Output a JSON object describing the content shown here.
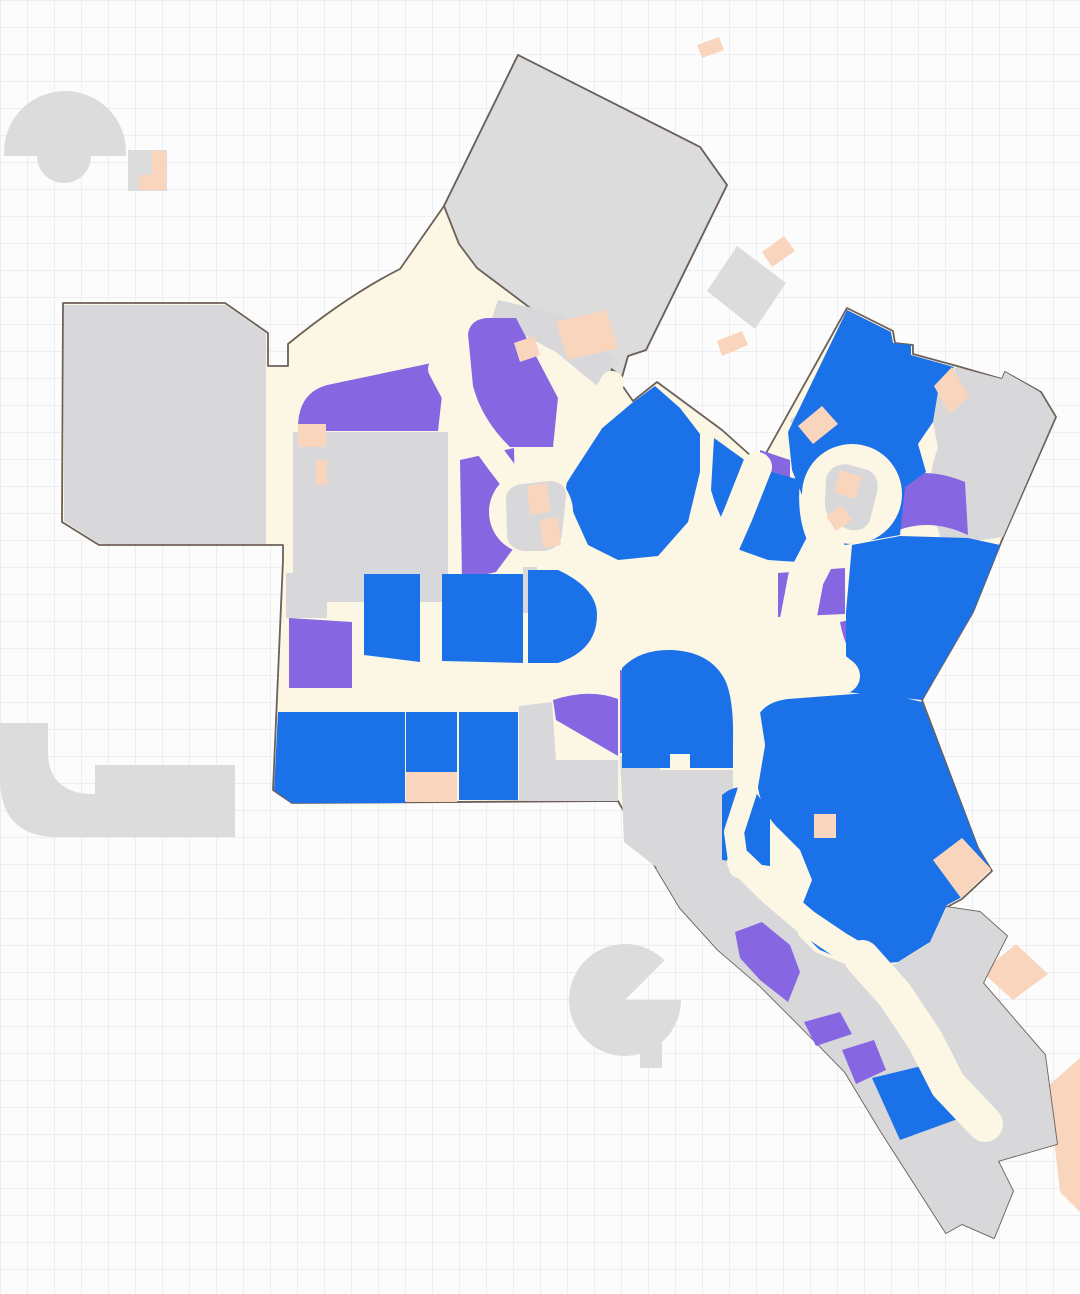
{
  "canvas": {
    "width": 1080,
    "height": 1294,
    "background": "#fcfcfd",
    "grid_color": "#eaeaee",
    "grid_size": 27
  },
  "palette": {
    "walkway": "#fbf7e4",
    "store_blue": "#1b72e8",
    "store_purple": "#8766e2",
    "store_peach": "#fad5bd",
    "store_gray": "#d8d8db",
    "detached_gray": "#dcdcdd",
    "outline": "#6c6058"
  },
  "map": {
    "name": "mall-floor-map",
    "shapes": [
      {
        "kind": "path",
        "name": "other-floor-fan-top-left",
        "fill": "detached_gray",
        "interactable": false,
        "d": "M4,152 A61,61 0 0 1 126,152 L126,156 L91,156 A27,27 0 0 1 37,156 L4,156 Z"
      },
      {
        "kind": "path",
        "name": "other-floor-unit-top-left",
        "fill": "detached_gray",
        "interactable": false,
        "d": "M128,150 L167,150 L167,191 L128,191 Z"
      },
      {
        "kind": "path",
        "name": "peach-unit-top-left",
        "fill": "store_peach",
        "interactable": false,
        "d": "M152,151 L166,151 L166,190 L139,190 L139,175 L152,175 Z"
      },
      {
        "kind": "path",
        "name": "other-floor-unit-upper-right",
        "fill": "detached_gray",
        "interactable": false,
        "d": "M737,246 L786,283 L755,329 L707,291 Z"
      },
      {
        "kind": "path",
        "name": "peach-strip-upper-right-a",
        "fill": "store_peach",
        "interactable": false,
        "d": "M762,252 L784,236 L795,251 L772,267 Z"
      },
      {
        "kind": "path",
        "name": "peach-strip-upper-right-b",
        "fill": "store_peach",
        "interactable": false,
        "d": "M717,341 L742,331 L748,345 L722,356 Z"
      },
      {
        "kind": "path",
        "name": "peach-strip-top",
        "fill": "store_peach",
        "interactable": false,
        "d": "M697,45 L719,37 L724,50 L702,58 Z"
      },
      {
        "kind": "path",
        "name": "other-floor-hook-lower-left",
        "fill": "detached_gray",
        "interactable": false,
        "d": "M0,723 L48,723 L48,755 Q50,792 90,794 L95,794 L95,765 L235,765 L235,837 L52,837 Q0,834 0,778 Z"
      },
      {
        "kind": "path",
        "name": "other-floor-fan-bottom",
        "fill": "detached_gray",
        "interactable": false,
        "d": "M625,1000 L664.6,960.4 A56,56 0 1 0 681,1000 Z"
      },
      {
        "kind": "path",
        "name": "other-floor-fan-bottom-tab",
        "fill": "detached_gray",
        "interactable": false,
        "d": "M640,1038 L662,1038 L662,1068 L640,1068 Z"
      },
      {
        "kind": "path",
        "name": "peach-block-right-lower",
        "fill": "store_peach",
        "interactable": false,
        "d": "M1048,1086 L1080,1058 L1080,1212 L1060,1192 Z"
      },
      {
        "kind": "path",
        "name": "peach-block-right-mid",
        "fill": "store_peach",
        "interactable": false,
        "d": "M982,972 L1016,944 L1048,974 L1013,1000 Z"
      },
      {
        "kind": "path",
        "name": "mall-walkway-footprint",
        "fill": "walkway",
        "stroke": true,
        "interactable": true,
        "d": "M63,303 L225,303 L268,333 L268,366 L288,366 L288,344 C315,322 356,291 400,269 L444,206 L518,55 L700,147 L727,185 L646,350 L628,356 L622,377 L610,368 L633,401 L657,382 L722,430 L760,464 L847,308 L893,331 L895,343 L913,345 L913,354 L957,366 L1002,379 L1005,372 L1041,392 L1056,417 L1002,540 L973,612 L922,700 L978,848 L992,871 L962,899 L947,907 L980,912 L1007,936 L983,983 L1045,1055 L1057,1144 L998,1161 L1013,1191 L994,1238 L962,1224 L946,1233 L880,1130 L845,1072 L800,1026 L760,986 L718,950 L680,908 L656,868 L618,801 L292,803 L273,790 L283,560 L283,545 L99,545 L62,522 Z"
      },
      {
        "kind": "path",
        "name": "anchor-store-top",
        "fill": "detached_gray",
        "stroke": true,
        "interactable": true,
        "d": "M518,55 L700,147 L727,185 L646,350 L628,356 L622,377 L610,368 L477,268 L459,244 L444,206 Z"
      },
      {
        "kind": "path",
        "name": "anchor-store-left",
        "fill": "store_gray",
        "interactable": true,
        "d": "M64,305 L225,305 L266,333 L266,544 L100,544 L64,521 Z"
      },
      {
        "kind": "path",
        "name": "service-block-left",
        "fill": "store_gray",
        "interactable": true,
        "d": "M293,432 L448,432 L448,602 L327,602 L327,618 L286,618 L286,573 L293,573 Z"
      },
      {
        "kind": "path",
        "name": "service-strip-top-center",
        "fill": "store_gray",
        "interactable": true,
        "d": "M498,300 L560,314 L616,357 L602,390 L556,352 L492,318 Z"
      },
      {
        "kind": "path",
        "name": "service-block-northeast",
        "fill": "store_gray",
        "interactable": true,
        "d": "M790,420 L818,398 L848,424 L848,462 L808,464 Z"
      },
      {
        "kind": "path",
        "name": "anchor-store-right",
        "fill": "store_gray",
        "interactable": true,
        "d": "M956,367 L1002,379 L1005,372 L1040,392 L1055,417 L1003,537 L944,545 Q920,492 938,448 L933,422 L938,392 Z"
      },
      {
        "kind": "path",
        "name": "service-block-south",
        "fill": "store_gray",
        "interactable": true,
        "d": "M519,706 L552,702 L556,760 L618,760 L618,801 L519,801 Z"
      },
      {
        "kind": "path",
        "name": "service-block-southeast",
        "fill": "store_gray",
        "interactable": true,
        "d": "M620,756 L660,756 L660,770 L733,770 L733,800 L745,800 L745,842 L718,872 L660,870 L624,842 Z"
      },
      {
        "kind": "path",
        "name": "tail-service-area",
        "fill": "store_gray",
        "interactable": true,
        "d": "M656,868 L680,908 L718,950 L760,986 L800,1026 L845,1072 L880,1130 L946,1233 L962,1224 L994,1238 L1013,1191 L998,1161 L1057,1144 L1045,1055 L983,983 L1007,936 L980,912 L947,907 L928,944 L895,964 L855,968 L815,952 L798,935 L797,906 L780,885 L735,845 L700,855 Z"
      },
      {
        "kind": "path",
        "name": "service-sliver-center",
        "fill": "store_gray",
        "interactable": true,
        "d": "M523,567 L537,567 L537,613 L523,613 Z"
      },
      {
        "kind": "path",
        "name": "store-purple-wing-band",
        "fill": "store_purple",
        "interactable": true,
        "d": "M298,428 Q298,390 332,384 L446,360 L438,431 L298,431 Z"
      },
      {
        "kind": "path",
        "name": "store-purple-upper-center",
        "fill": "store_purple",
        "interactable": true,
        "d": "M468,334 Q470,320 486,318 L516,318 L558,398 L553,447 L510,447 Q482,420 473,386 Z"
      },
      {
        "kind": "path",
        "name": "store-purple-mid-left",
        "fill": "store_purple",
        "interactable": true,
        "d": "M460,460 L514,448 L516,545 L496,572 L462,580 Z"
      },
      {
        "kind": "path",
        "name": "store-purple-lower-left",
        "fill": "store_purple",
        "interactable": true,
        "d": "M289,618 L352,622 L352,688 L289,688 Z"
      },
      {
        "kind": "path",
        "name": "store-purple-band-right",
        "fill": "store_purple",
        "interactable": true,
        "d": "M886,480 Q925,465 965,482 L968,535 Q925,515 888,535 Z"
      },
      {
        "kind": "path",
        "name": "store-purple-neck-west",
        "fill": "store_purple",
        "interactable": true,
        "d": "M760,450 L790,460 L790,494 L760,502 Z"
      },
      {
        "kind": "path",
        "name": "store-purple-band-mid",
        "fill": "store_purple",
        "interactable": true,
        "d": "M778,573 L845,568 L845,614 L778,617 Z"
      },
      {
        "kind": "path",
        "name": "store-purple-wedge-east",
        "fill": "store_purple",
        "interactable": true,
        "d": "M840,622 Q882,612 922,617 L965,626 L920,698 L868,680 Q845,652 840,622 Z"
      },
      {
        "kind": "path",
        "name": "store-purple-wedge-south",
        "fill": "store_purple",
        "interactable": true,
        "d": "M553,700 Q590,688 618,699 L618,756 L580,734 L556,720 Z"
      },
      {
        "kind": "path",
        "name": "store-purple-sliver-south",
        "fill": "store_purple",
        "interactable": true,
        "d": "M620,670 L637,673 L637,753 L620,753 Z"
      },
      {
        "kind": "path",
        "name": "store-purple-arc-tail",
        "fill": "store_purple",
        "interactable": true,
        "d": "M735,932 L762,922 L790,945 L800,972 L788,1002 L760,980 L740,958 Z"
      },
      {
        "kind": "path",
        "name": "store-purple-tail-a",
        "fill": "store_purple",
        "interactable": true,
        "d": "M804,1022 L840,1012 L852,1034 L816,1046 Z"
      },
      {
        "kind": "path",
        "name": "store-purple-tail-b",
        "fill": "store_purple",
        "interactable": true,
        "d": "M842,1050 L874,1040 L886,1070 L856,1084 Z"
      },
      {
        "kind": "path",
        "name": "store-blue-row1-a",
        "fill": "store_blue",
        "interactable": true,
        "d": "M364,574 L420,574 L420,662 L364,655 Z"
      },
      {
        "kind": "path",
        "name": "store-blue-row1-b",
        "fill": "store_blue",
        "interactable": true,
        "d": "M442,574 L523,574 L523,663 L442,661 Z"
      },
      {
        "kind": "path",
        "name": "store-blue-row1-c",
        "fill": "store_blue",
        "interactable": true,
        "d": "M528,570 L558,570 Q597,588 597,615 Q597,650 558,663 L528,663 Z"
      },
      {
        "kind": "path",
        "name": "store-blue-center-west",
        "fill": "store_blue",
        "interactable": true,
        "d": "M570,462 L600,430 L632,403 L655,386 L680,408 L700,434 L700,472 L688,522 L658,556 L618,560 L588,545 L574,514 L566,488 Z"
      },
      {
        "kind": "path",
        "name": "store-blue-center-east",
        "fill": "store_blue",
        "interactable": true,
        "d": "M714,438 L750,464 L775,473 L800,480 Q796,520 810,546 L798,562 L768,560 L740,550 Q719,520 711,490 Z"
      },
      {
        "kind": "path",
        "name": "store-blue-northeast-block",
        "fill": "store_blue",
        "interactable": true,
        "d": "M788,432 L847,310 L891,332 L893,343 L911,345 L911,355 L954,367 L938,392 L933,422 L918,444 L926,472 L905,487 L900,535 L845,545 L812,520 L792,470 Z"
      },
      {
        "kind": "path",
        "name": "store-blue-east-lower",
        "fill": "store_blue",
        "interactable": true,
        "d": "M846,612 L852,545 L900,536 L968,538 L1000,545 L973,612 L922,700 L846,692 Z"
      },
      {
        "kind": "path",
        "name": "store-blue-southcenter-a",
        "fill": "store_blue",
        "interactable": true,
        "d": "M622,668 Q640,649 672,650 Q712,652 726,682 Q734,702 733,742 L733,768 L690,768 L690,754 L670,754 L670,768 L622,768 Z"
      },
      {
        "kind": "path",
        "name": "store-blue-southeast-large",
        "fill": "store_blue",
        "interactable": true,
        "d": "M755,722 Q762,702 788,699 L880,692 L922,702 L978,848 L990,868 L962,897 L947,905 L930,942 L898,962 L858,966 L820,950 Q800,934 801,908 L812,880 L800,850 L780,830 Q760,812 757,780 Z"
      },
      {
        "kind": "path",
        "name": "store-blue-southcenter-b",
        "fill": "store_blue",
        "interactable": true,
        "d": "M722,795 Q740,780 757,794 L770,812 L770,866 L722,860 Z"
      },
      {
        "kind": "path",
        "name": "store-blue-row2-a",
        "fill": "store_blue",
        "interactable": true,
        "d": "M278,712 L405,712 L405,803 L292,803 L274,790 Z"
      },
      {
        "kind": "path",
        "name": "store-blue-row2-b",
        "fill": "store_blue",
        "interactable": true,
        "d": "M406,712 L457,712 L457,772 L406,772 Z"
      },
      {
        "kind": "path",
        "name": "store-blue-row2-c",
        "fill": "store_blue",
        "interactable": true,
        "d": "M459,712 L518,712 L518,800 L459,800 Z"
      },
      {
        "kind": "path",
        "name": "store-blue-tail",
        "fill": "store_blue",
        "interactable": true,
        "d": "M872,1078 L938,1062 L966,1116 L900,1140 Z"
      },
      {
        "kind": "path",
        "name": "store-peach-wing-a",
        "fill": "store_peach",
        "interactable": true,
        "d": "M298,424 L326,424 L326,447 L298,447 Z"
      },
      {
        "kind": "path",
        "name": "store-peach-wing-b",
        "fill": "store_peach",
        "interactable": true,
        "d": "M316,460 L327,460 L327,485 L316,485 Z"
      },
      {
        "kind": "path",
        "name": "store-peach-top-center",
        "fill": "store_peach",
        "interactable": true,
        "d": "M556,322 L606,310 L618,348 L568,360 Z"
      },
      {
        "kind": "path",
        "name": "store-peach-top-center-b",
        "fill": "store_peach",
        "interactable": true,
        "d": "M514,343 L534,336 L540,355 L520,362 Z"
      },
      {
        "kind": "path",
        "name": "store-peach-northeast",
        "fill": "store_peach",
        "interactable": true,
        "d": "M934,386 L952,367 L969,396 L950,414 Z"
      },
      {
        "kind": "path",
        "name": "store-peach-center-east",
        "fill": "store_peach",
        "interactable": true,
        "d": "M798,426 L822,406 L838,424 L813,444 Z"
      },
      {
        "kind": "path",
        "name": "store-peach-se-small",
        "fill": "store_peach",
        "interactable": true,
        "d": "M814,814 L836,814 L836,838 L814,838 Z"
      },
      {
        "kind": "path",
        "name": "store-peach-se-corner",
        "fill": "store_peach",
        "interactable": true,
        "d": "M933,860 L962,838 L991,869 L961,898 Z"
      },
      {
        "kind": "path",
        "name": "store-peach-row2",
        "fill": "store_peach",
        "interactable": true,
        "d": "M406,772 L457,772 L457,802 L406,802 Z"
      },
      {
        "kind": "path",
        "name": "store-peach-tail",
        "fill": "store_peach",
        "interactable": true,
        "d": "M902,1008 L922,1003 L928,1021 L908,1027 Z"
      },
      {
        "kind": "circle",
        "name": "walkway-roundabout-west",
        "fill": "walkway",
        "interactable": false,
        "cx": 531,
        "cy": 512,
        "r": 42
      },
      {
        "kind": "line",
        "name": "walkway-corridor-wing",
        "interactable": false,
        "width": 24,
        "points": [
          [
            440,
            369
          ],
          [
            466,
            418
          ],
          [
            498,
            462
          ],
          [
            524,
            496
          ]
        ]
      },
      {
        "kind": "line",
        "name": "walkway-corridor-center",
        "interactable": false,
        "width": 24,
        "points": [
          [
            612,
            383
          ],
          [
            590,
            425
          ],
          [
            562,
            468
          ],
          [
            542,
            500
          ]
        ]
      },
      {
        "kind": "line",
        "name": "walkway-corridor-apex",
        "interactable": false,
        "width": 30,
        "points": [
          [
            757,
            467
          ],
          [
            738,
            515
          ],
          [
            716,
            565
          ],
          [
            698,
            602
          ]
        ]
      },
      {
        "kind": "circle",
        "name": "walkway-roundabout-east",
        "fill": "walkway",
        "interactable": false,
        "cx": 852,
        "cy": 494,
        "r": 50
      },
      {
        "kind": "line",
        "name": "walkway-neck-east",
        "interactable": false,
        "width": 36,
        "points": [
          [
            830,
            532
          ],
          [
            806,
            578
          ],
          [
            798,
            620
          ],
          [
            812,
            652
          ],
          [
            842,
            676
          ]
        ]
      },
      {
        "kind": "line",
        "name": "walkway-scurve-south",
        "interactable": false,
        "width": 20,
        "points": [
          [
            744,
            662
          ],
          [
            748,
            700
          ],
          [
            755,
            745
          ],
          [
            747,
            792
          ],
          [
            734,
            832
          ],
          [
            739,
            868
          ]
        ]
      },
      {
        "kind": "line",
        "name": "walkway-corridor-se",
        "interactable": false,
        "width": 26,
        "points": [
          [
            740,
            862
          ],
          [
            772,
            893
          ],
          [
            806,
            922
          ],
          [
            840,
            945
          ],
          [
            862,
            958
          ]
        ]
      },
      {
        "kind": "line",
        "name": "walkway-corridor-tail",
        "interactable": false,
        "width": 36,
        "points": [
          [
            862,
            958
          ],
          [
            895,
            995
          ],
          [
            925,
            1040
          ],
          [
            948,
            1085
          ],
          [
            985,
            1124
          ]
        ]
      },
      {
        "kind": "path",
        "name": "kiosk-west",
        "fill": "store_gray",
        "interactable": true,
        "d": "M506,497 Q508,486 522,484 L550,481 Q566,482 566,496 L562,534 Q560,549 544,551 L524,551 Q508,549 507,535 Z"
      },
      {
        "kind": "path",
        "name": "kiosk-west-peach-a",
        "fill": "store_peach",
        "interactable": true,
        "d": "M527,486 L547,483 L550,512 L530,515 Z"
      },
      {
        "kind": "path",
        "name": "kiosk-west-peach-b",
        "fill": "store_peach",
        "interactable": true,
        "d": "M540,520 L558,517 L561,545 L543,548 Z"
      },
      {
        "kind": "path",
        "name": "kiosk-east",
        "fill": "store_gray",
        "interactable": true,
        "d": "M826,478 Q830,465 846,464 L868,470 Q880,476 877,492 L870,520 Q865,532 850,530 L836,524 Q824,516 825,500 Z"
      },
      {
        "kind": "path",
        "name": "kiosk-east-peach-a",
        "fill": "store_peach",
        "interactable": true,
        "d": "M840,470 L862,477 L855,499 L834,492 Z"
      },
      {
        "kind": "path",
        "name": "kiosk-east-peach-b",
        "fill": "store_peach",
        "interactable": true,
        "d": "M826,516 L842,505 L852,520 L836,531 Z"
      }
    ]
  }
}
